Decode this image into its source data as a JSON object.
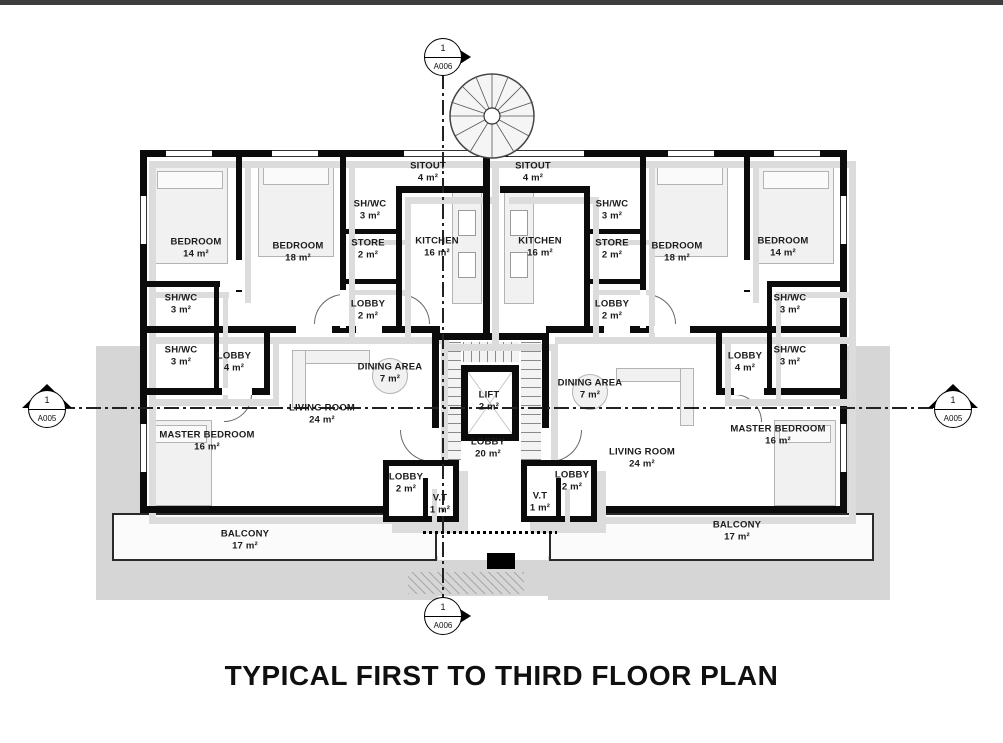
{
  "title": "TYPICAL FIRST TO THIRD FLOOR PLAN",
  "markers": {
    "top": {
      "number": "1",
      "sheet": "A006"
    },
    "bottom": {
      "number": "1",
      "sheet": "A006"
    },
    "left": {
      "number": "1",
      "sheet": "A005"
    },
    "right": {
      "number": "1",
      "sheet": "A005"
    }
  },
  "rooms": [
    {
      "name": "BEDROOM",
      "area": "14 m²"
    },
    {
      "name": "BEDROOM",
      "area": "18 m²"
    },
    {
      "name": "SH/WC",
      "area": "3 m²"
    },
    {
      "name": "STORE",
      "area": "2 m²"
    },
    {
      "name": "KITCHEN",
      "area": "16 m²"
    },
    {
      "name": "SITOUT",
      "area": "4 m²"
    },
    {
      "name": "LOBBY",
      "area": "2 m²"
    },
    {
      "name": "SH/WC",
      "area": "3 m²"
    },
    {
      "name": "SH/WC",
      "area": "3 m²"
    },
    {
      "name": "LOBBY",
      "area": "4 m²"
    },
    {
      "name": "DINING AREA",
      "area": "7 m²"
    },
    {
      "name": "LIVING ROOM",
      "area": "24 m²"
    },
    {
      "name": "MASTER BEDROOM",
      "area": "16 m²"
    },
    {
      "name": "BALCONY",
      "area": "17 m²"
    },
    {
      "name": "LOBBY",
      "area": "2 m²"
    },
    {
      "name": "V.T",
      "area": "1 m²"
    },
    {
      "name": "LIFT",
      "area": "2 m²"
    },
    {
      "name": "LOBBY",
      "area": "20 m²"
    },
    {
      "name": "SITOUT",
      "area": "4 m²"
    },
    {
      "name": "KITCHEN",
      "area": "16 m²"
    },
    {
      "name": "SH/WC",
      "area": "3 m²"
    },
    {
      "name": "STORE",
      "area": "2 m²"
    },
    {
      "name": "LOBBY",
      "area": "2 m²"
    },
    {
      "name": "BEDROOM",
      "area": "18 m²"
    },
    {
      "name": "BEDROOM",
      "area": "14 m²"
    },
    {
      "name": "SH/WC",
      "area": "3 m²"
    },
    {
      "name": "SH/WC",
      "area": "3 m²"
    },
    {
      "name": "LOBBY",
      "area": "4 m²"
    },
    {
      "name": "DINING AREA",
      "area": "7 m²"
    },
    {
      "name": "LIVING ROOM",
      "area": "24 m²"
    },
    {
      "name": "MASTER BEDROOM",
      "area": "16 m²"
    },
    {
      "name": "BALCONY",
      "area": "17 m²"
    },
    {
      "name": "LOBBY",
      "area": "2 m²"
    },
    {
      "name": "V.T",
      "area": "1 m²"
    }
  ],
  "colors": {
    "wall": "#0b0b0b",
    "shadow": "#d8d8d8",
    "text": "#1b1b1b"
  }
}
